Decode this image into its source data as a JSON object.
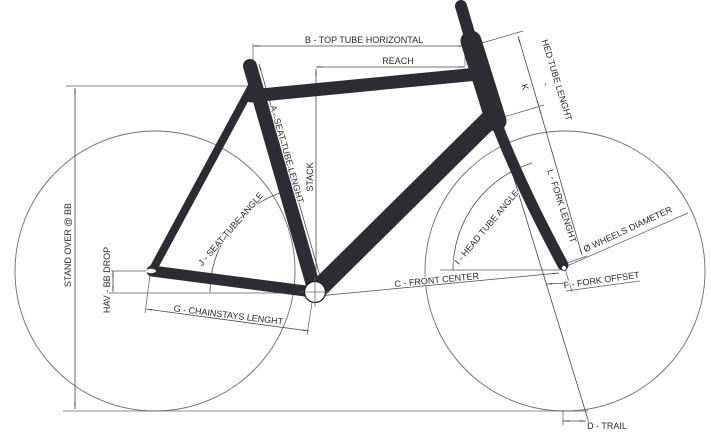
{
  "diagram": {
    "type": "bicycle-frame-geometry",
    "colors": {
      "background": "#ffffff",
      "frame": "#2d2d31",
      "dimension_lines": "#4a4a4a",
      "wheel_outline": "#6e6e6e",
      "text": "#2a2a2a"
    },
    "labels": {
      "top_tube_horizontal": "B - TOP TUBE HORIZONTAL",
      "reach": "REACH",
      "stack": "STACK",
      "seat_tube_length": "A - SEAT TUBE LENGHT",
      "stand_over": "STAND OVER @ BB",
      "bb_drop": "HAV - BB DROP",
      "chainstays_length": "G - CHAINSTAYS LENGHT",
      "seat_tube_angle": "J - SEAT TUBE ANGLE",
      "head_tube_angle": "I - HEAD TUBE ANGLE",
      "front_center": "C - FRONT CENTER",
      "fork_offset": "F - FORK OFFSET",
      "trail": "D - TRAIL",
      "wheels_diameter": "Ø WHEELS DIAMETER",
      "head_tube_k": "K",
      "head_tube_dash": "-",
      "head_tube_length": "HED TUBE LENGHT",
      "fork_length": "L - FORK LENGHT"
    }
  }
}
